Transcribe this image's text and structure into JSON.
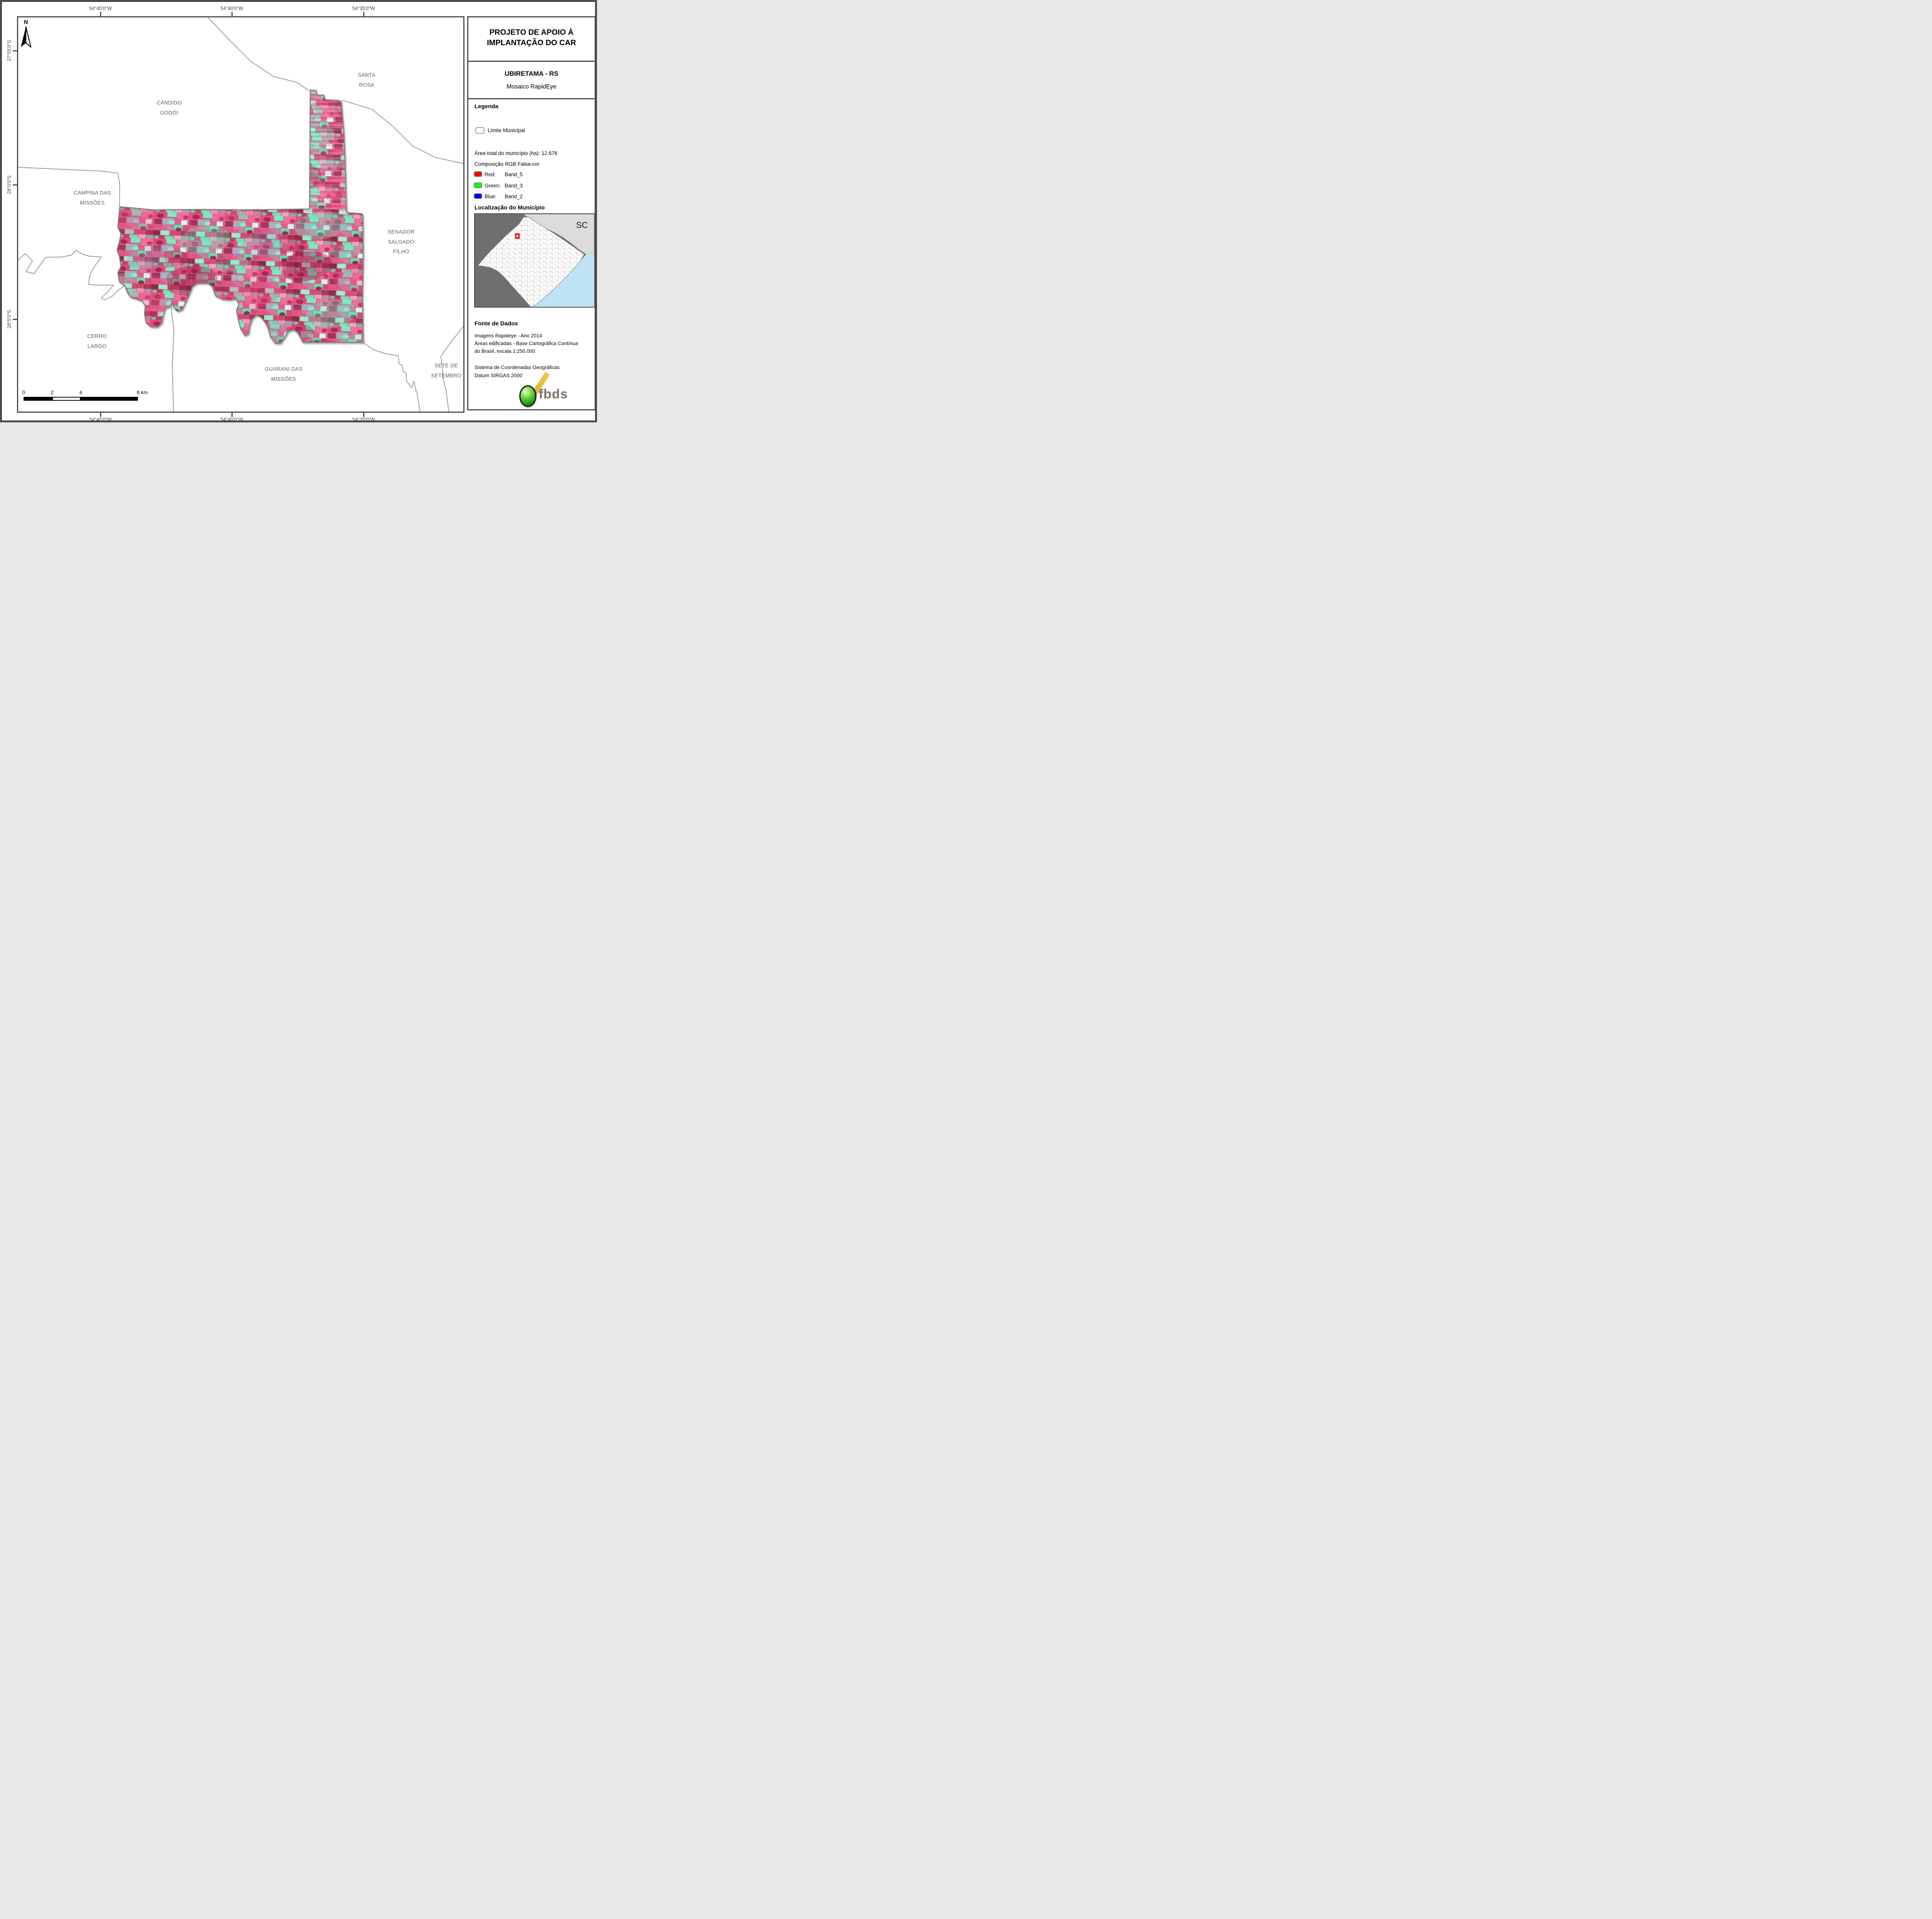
{
  "header": {
    "title_line1": "PROJETO DE APOIO À",
    "title_line2": "IMPLANTAÇÃO DO CAR",
    "municipality": "UBIRETAMA - RS",
    "product": "Mosaico RapidEye"
  },
  "legend": {
    "heading": "Legenda",
    "limite_label": "Limite Municipal",
    "area_total": "Área total do município (ha): 12.676",
    "composicao": "Composição RGB Falsa-cor",
    "bands": [
      {
        "channel": "Red:",
        "band": "Band_5",
        "color": "#ff0000"
      },
      {
        "channel": "Green:",
        "band": "Band_3",
        "color": "#00ff00"
      },
      {
        "channel": "Blue:",
        "band": "Band_2",
        "color": "#0000ff"
      }
    ]
  },
  "localizacao": {
    "heading": "Localização do Município",
    "region_label": "SC",
    "marker_color": "#ee1111",
    "ocean_color": "#bfe3f5",
    "state_bg": "#6f6f6f"
  },
  "fonte": {
    "heading": "Fonte de Dados",
    "lines": [
      "Imagens Rapideye - Ano 2014",
      "Áreas edificadas - Base Cartográfica Contínua",
      "do Brasil, escala 1:250.000",
      "Sistema de Coordenadas Geográficas",
      "Datum SIRGAS 2000"
    ]
  },
  "logo": {
    "text": "fbds"
  },
  "map": {
    "north_label": "N",
    "neighbor_labels": [
      {
        "name": "candido-godoi",
        "lines": [
          "CÂNDIDO",
          "GODÓI"
        ]
      },
      {
        "name": "santa-rosa",
        "lines": [
          "SANTA",
          "ROSA"
        ]
      },
      {
        "name": "campina-das-missoes",
        "lines": [
          "CAMPINA DAS",
          "MISSÕES"
        ]
      },
      {
        "name": "senador-salgado-filho",
        "lines": [
          "SENADOR",
          "SALGADO",
          "FILHO"
        ]
      },
      {
        "name": "cerro-largo",
        "lines": [
          "CERRO",
          "LARGO"
        ]
      },
      {
        "name": "guarani-das-missoes",
        "lines": [
          "GUARANI DAS",
          "MISSÕES"
        ]
      },
      {
        "name": "sete-de-setembro",
        "lines": [
          "SETE DE",
          "SETEMBRO"
        ]
      }
    ],
    "coordinates": {
      "top": [
        "54°45'0\"W",
        "54°40'0\"W",
        "54°35'0\"W"
      ],
      "bottom": [
        "54°45'0\"W",
        "54°40'0\"W",
        "54°35'0\"W"
      ],
      "left": [
        "27°55'0\"S",
        "28°0'0\"S",
        "28°5'0\"S"
      ]
    },
    "scalebar": {
      "labels": [
        "0",
        "2",
        "4",
        "8 km"
      ]
    }
  }
}
